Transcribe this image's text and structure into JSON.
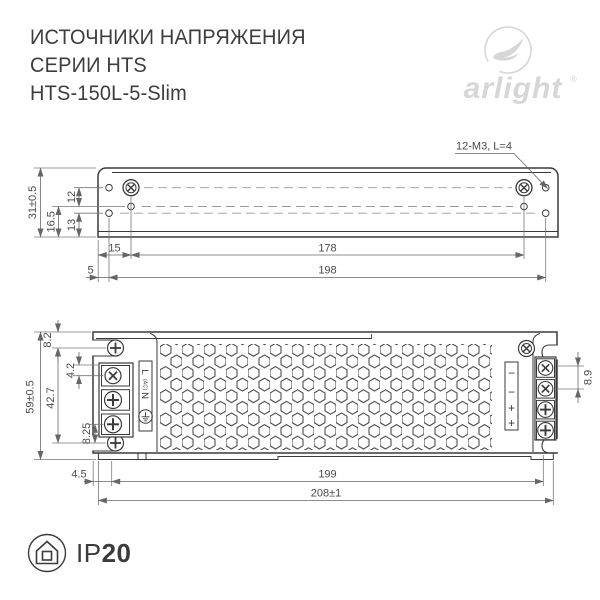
{
  "header": {
    "title_line1": "ИСТОЧНИКИ НАПРЯЖЕНИЯ",
    "title_line2": "СЕРИИ HTS",
    "model": "HTS-150L-5-Slim"
  },
  "brand": {
    "wordmark": "arlight",
    "registered_mark": "®"
  },
  "top_view": {
    "callout": "12-M3, L=4",
    "dim_height": "31±0.5",
    "dim_16_5": "16.5",
    "dim_12": "12",
    "dim_13": "13",
    "dim_15": "15",
    "dim_178": "178",
    "dim_5": "5",
    "dim_198": "198"
  },
  "front_view": {
    "dim_height": "59±0.5",
    "dim_8_2": "8.2",
    "dim_4_2": "4.2",
    "dim_42_7": "42.7",
    "dim_8_25": "8.25",
    "dim_8_9": "8.9",
    "dim_4_5": "4.5",
    "dim_199": "199",
    "dim_208": "208±1",
    "ac_label_l": "L",
    "ac_label_ac": "(AC)",
    "ac_label_n": "N",
    "dc_labels": [
      "−",
      "−",
      "+",
      "+"
    ]
  },
  "footer": {
    "ip_prefix": "IP",
    "ip_value": "20"
  },
  "icons": {
    "earth_ground": "⏚",
    "house_enclosure": "⌂",
    "logo_swoosh": "arlight-swoosh"
  },
  "colors": {
    "line": "#3a3a3a",
    "dimension": "#666666",
    "centerline": "#999999",
    "logo_gray": "#d6d6d6",
    "text_dark": "#3d3d3d"
  }
}
